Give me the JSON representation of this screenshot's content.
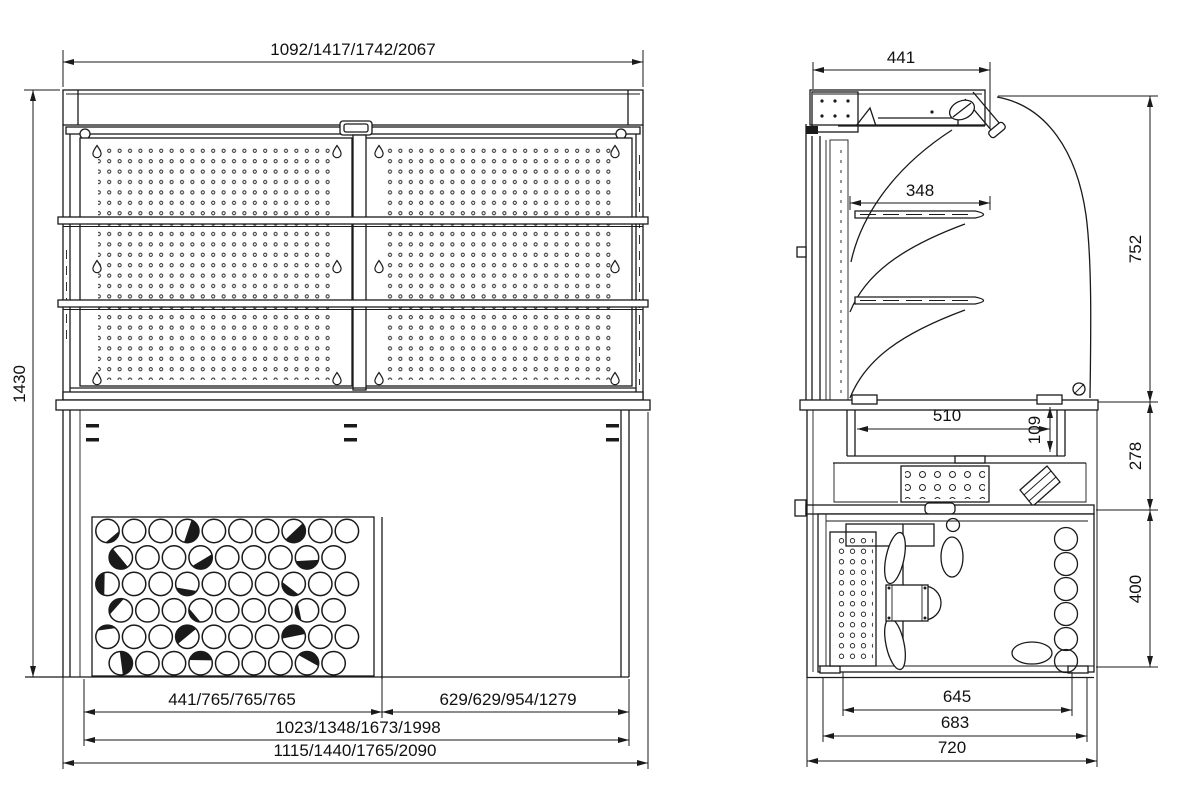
{
  "front_view": {
    "dim_width_top": "1092/1417/1742/2067",
    "dim_height": "1430",
    "dim_bottom_left": "441/765/765/765",
    "dim_bottom_right": "629/629/954/1279",
    "dim_bottom_inner": "1023/1348/1673/1998",
    "dim_bottom_overall": "1115/1440/1765/2090"
  },
  "side_view": {
    "dim_canopy_width": "441",
    "dim_shelf_width": "348",
    "dim_upper_height": "752",
    "dim_well_width": "510",
    "dim_well_depth": "109",
    "dim_mid_height": "278",
    "dim_base_height": "400",
    "dim_bottom_inner": "645",
    "dim_bottom_mid": "683",
    "dim_bottom_overall": "720"
  }
}
